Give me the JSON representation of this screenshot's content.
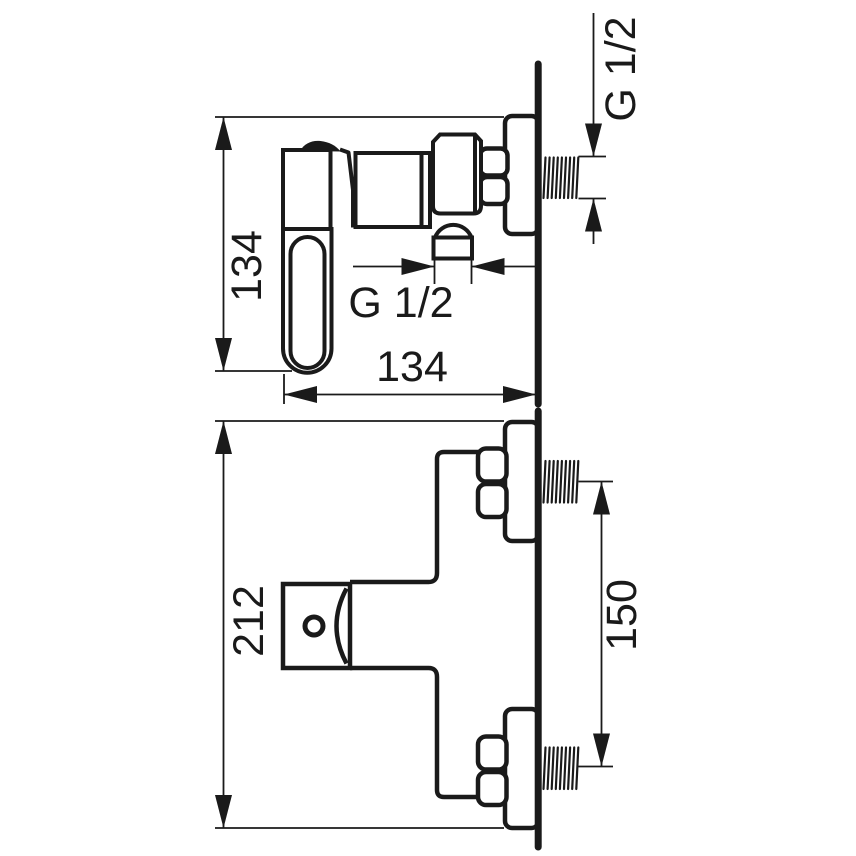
{
  "colors": {
    "line": "#1a1a1a",
    "background": "#ffffff"
  },
  "views": {
    "side": {
      "height_mm": "134",
      "width_mm": "134",
      "outlet_thread": "G 1/2",
      "connection_thread": "G 1/2"
    },
    "top": {
      "depth_mm": "212",
      "connection_spacing_mm": "150"
    }
  }
}
